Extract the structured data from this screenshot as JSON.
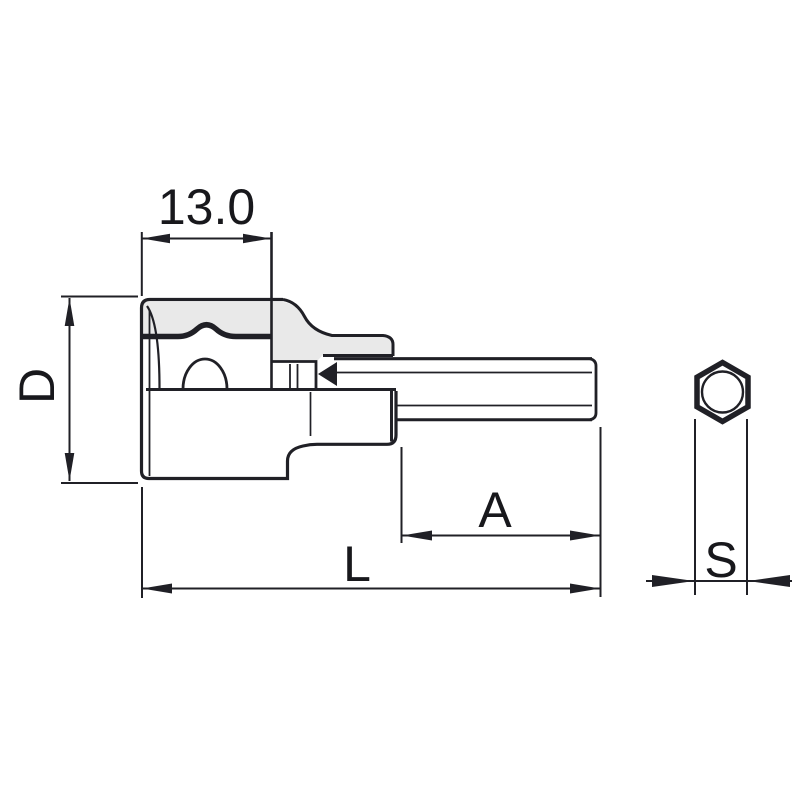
{
  "diagram": {
    "type": "technical-drawing",
    "subject": "hex bit socket side view with hex bit end view",
    "labels": {
      "drive_depth": "13.0",
      "body_diameter": "D",
      "bit_protrusion": "A",
      "overall_length": "L",
      "hex_width_across_flats": "S"
    },
    "colors": {
      "line": "#202026",
      "shade": "#e9e9e9",
      "background": "#ffffff",
      "text": "#18181c"
    }
  }
}
